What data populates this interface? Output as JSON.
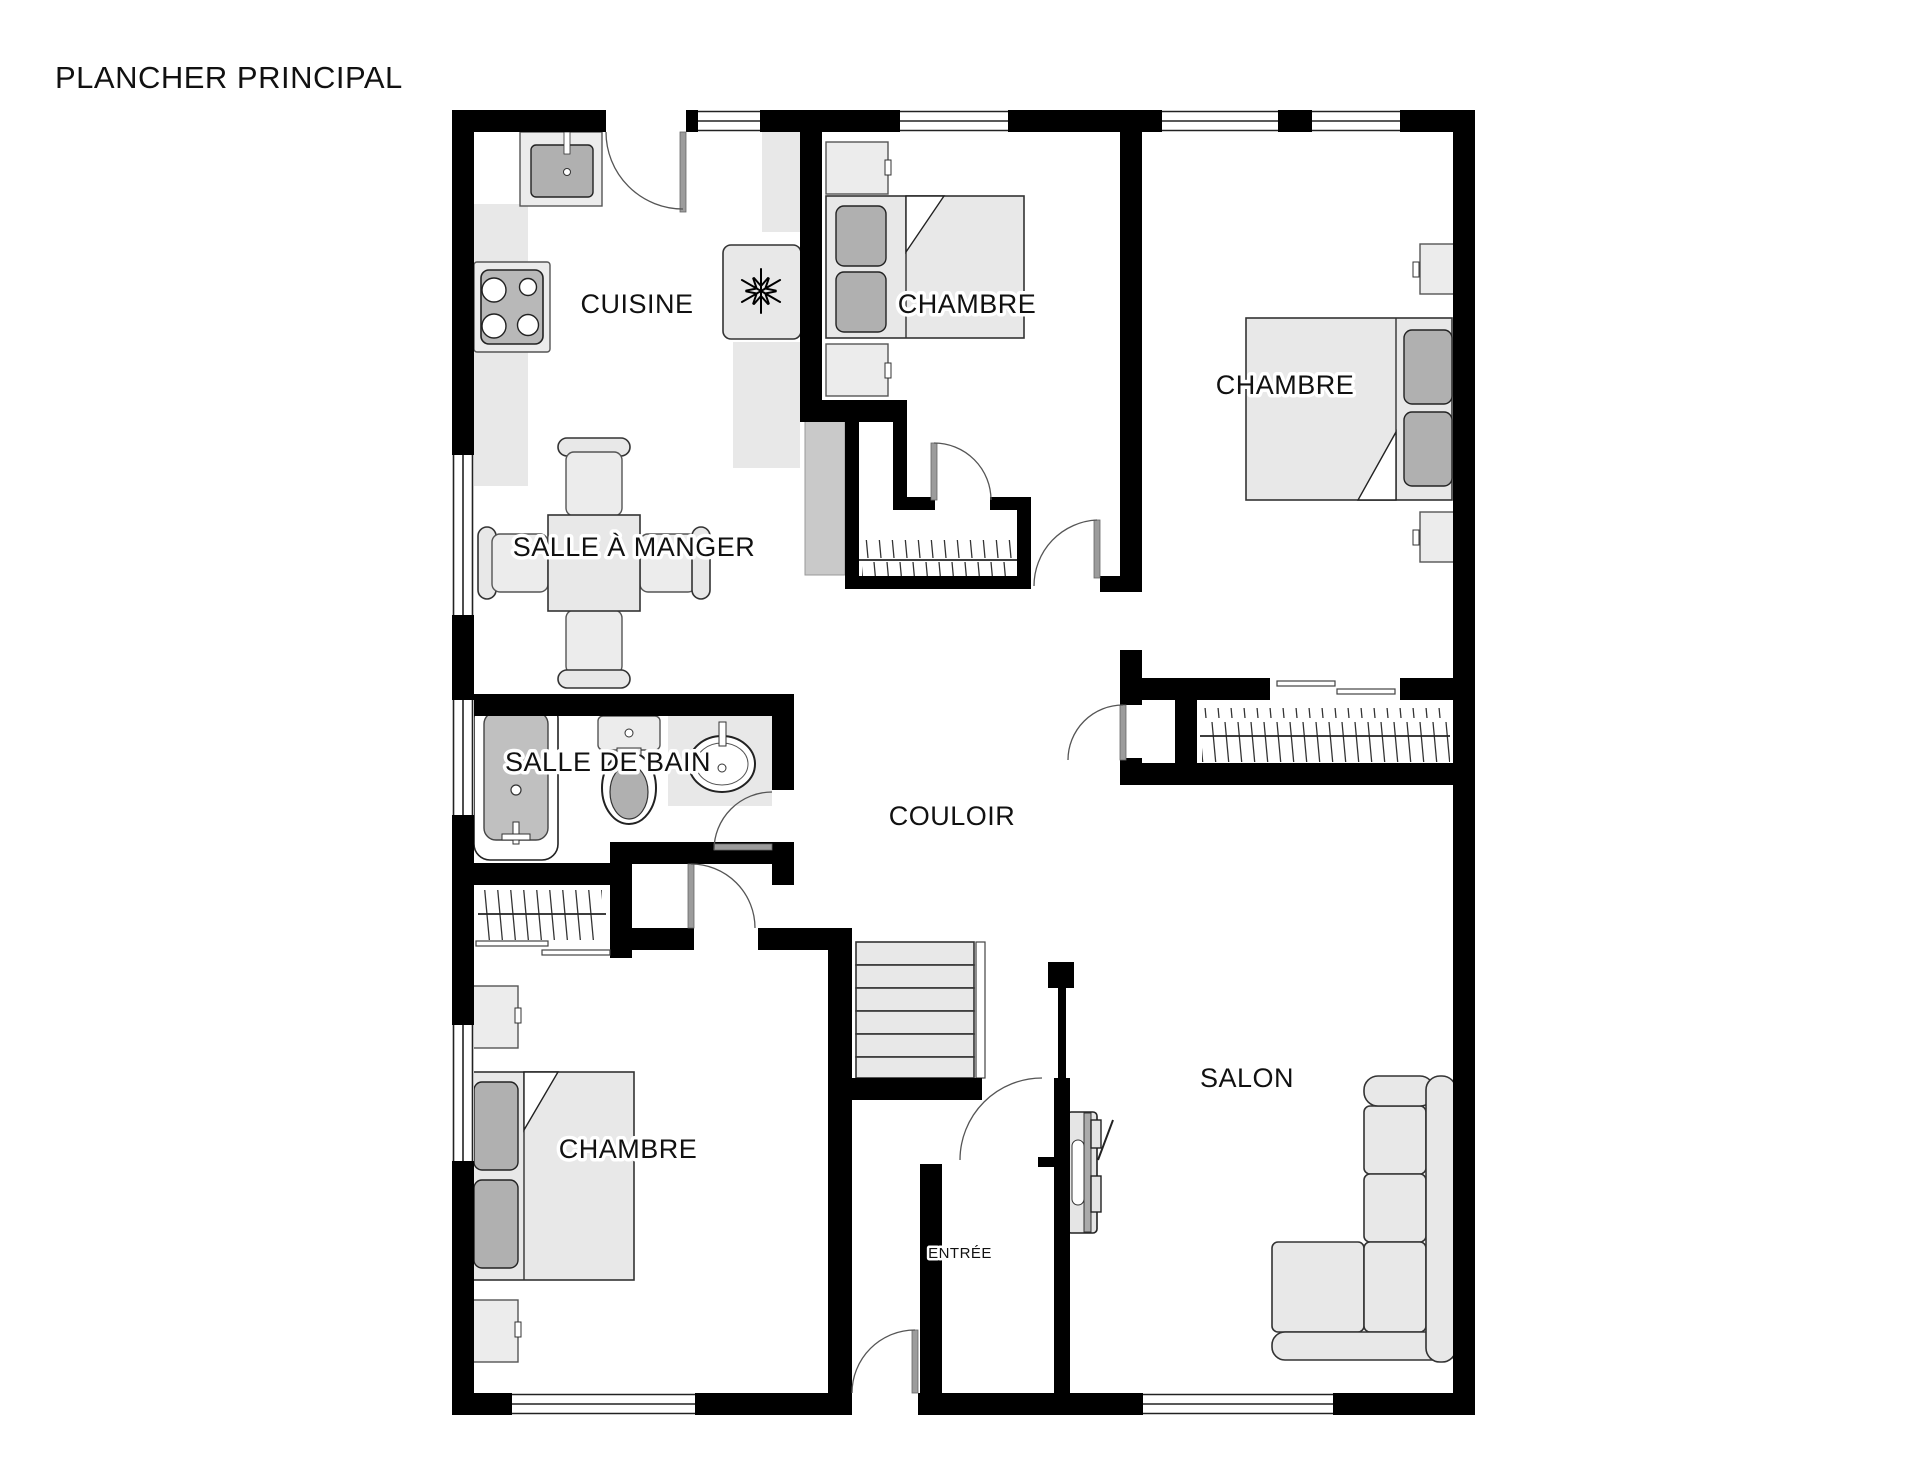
{
  "title": {
    "text": "PLANCHER PRINCIPAL"
  },
  "rooms": {
    "cuisine": {
      "label": "CUISINE"
    },
    "chambre_top": {
      "label": "CHAMBRE"
    },
    "chambre_right": {
      "label": "CHAMBRE"
    },
    "chambre_bottom": {
      "label": "CHAMBRE"
    },
    "salle_a_manger": {
      "label": "SALLE À MANGER"
    },
    "salle_de_bain": {
      "label": "SALLE DE BAIN"
    },
    "couloir": {
      "label": "COULOIR"
    },
    "salon": {
      "label": "SALON"
    },
    "entree": {
      "label": "ENTRÉE"
    }
  },
  "colors": {
    "wall": "#000000",
    "floor": "#ffffff",
    "furniture_light": "#e8e8e8",
    "furniture_mid": "#b0b0b0",
    "wardrobe_gray": "#c9c9c9",
    "label_text": "#111111"
  }
}
